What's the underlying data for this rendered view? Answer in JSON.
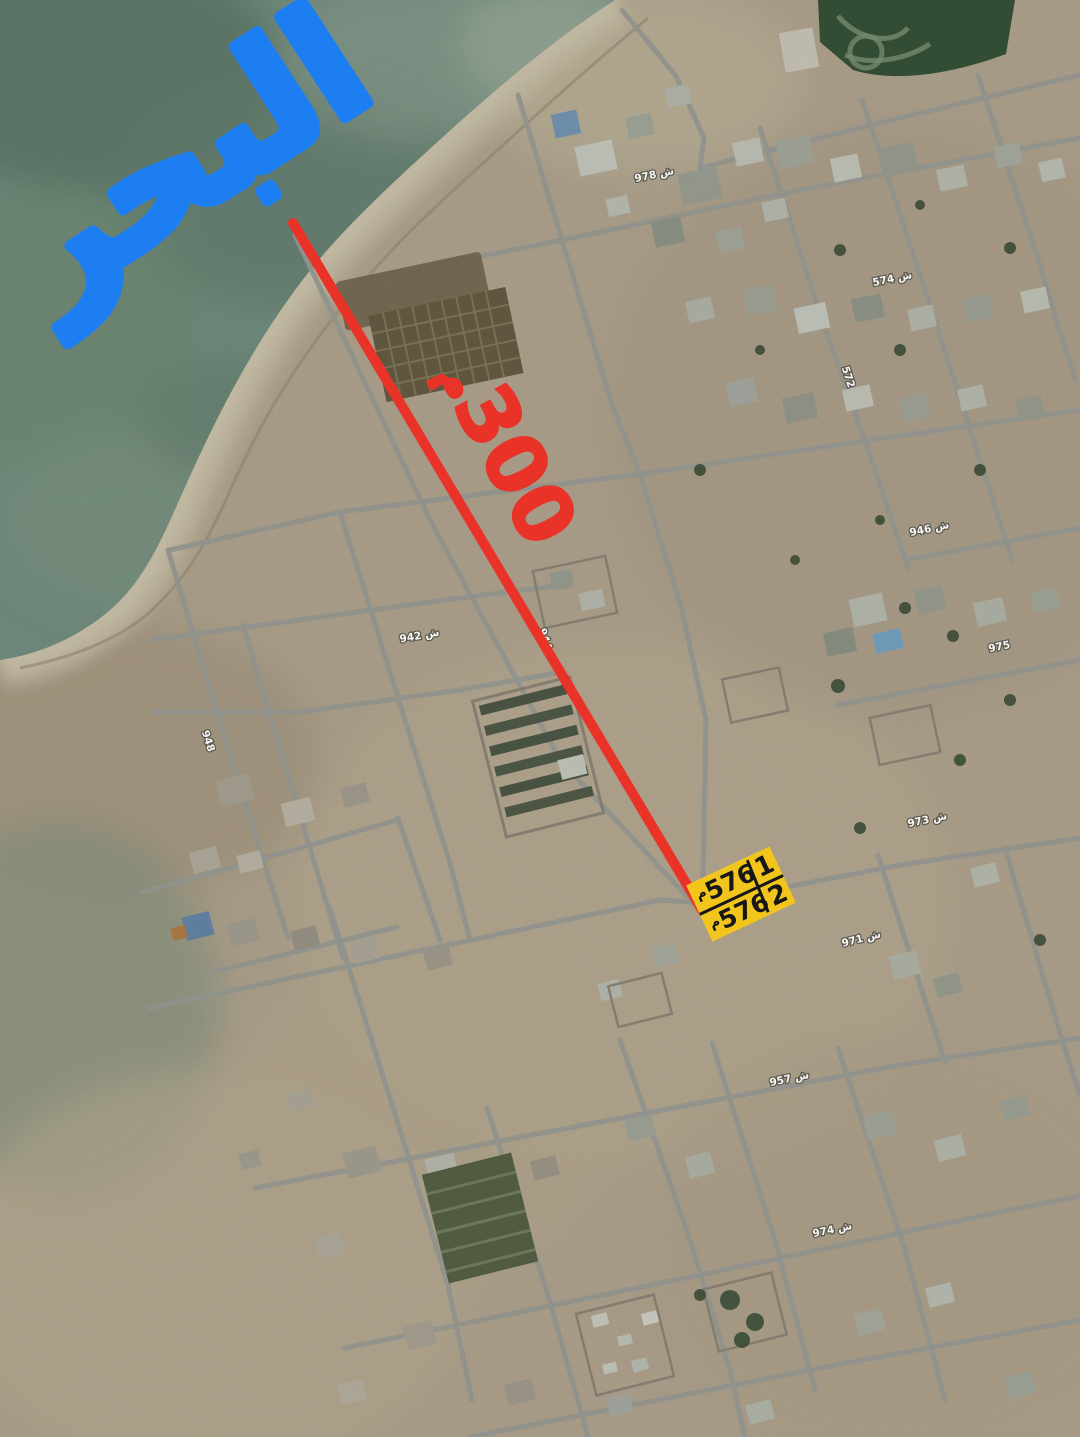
{
  "annotations": {
    "sea_label": {
      "text": "البحر",
      "color": "#1d7ef2"
    },
    "route_line": {
      "color": "#ea3328"
    },
    "distance_label": {
      "unit": "م",
      "value": "300",
      "color": "#ea3328"
    },
    "parcel_highlight": {
      "fill": "#f2c51d",
      "ink": "#171717",
      "rows": [
        {
          "unit": "م",
          "value": "576",
          "plot": "1"
        },
        {
          "unit": "م",
          "value": "576",
          "plot": "2"
        }
      ]
    }
  },
  "street_labels": [
    {
      "text": "978 ش",
      "x": 655,
      "y": 178,
      "rot": -12
    },
    {
      "text": "574 ش",
      "x": 893,
      "y": 282,
      "rot": -12
    },
    {
      "text": "572",
      "x": 845,
      "y": 378,
      "rot": 72
    },
    {
      "text": "946 ش",
      "x": 930,
      "y": 532,
      "rot": -12
    },
    {
      "text": "944",
      "x": 542,
      "y": 640,
      "rot": 72
    },
    {
      "text": "942 ش",
      "x": 420,
      "y": 639,
      "rot": -10
    },
    {
      "text": "975",
      "x": 1000,
      "y": 650,
      "rot": -12
    },
    {
      "text": "948",
      "x": 205,
      "y": 742,
      "rot": 72
    },
    {
      "text": "973 ش",
      "x": 928,
      "y": 823,
      "rot": -12
    },
    {
      "text": "971 ش",
      "x": 862,
      "y": 942,
      "rot": -14
    },
    {
      "text": "957 ش",
      "x": 790,
      "y": 1082,
      "rot": -12
    },
    {
      "text": "974 ش",
      "x": 833,
      "y": 1233,
      "rot": -12
    }
  ],
  "palette": {
    "sea": "#7e9c8d",
    "sand": "#c2b49c",
    "beach": "#d8cdb2",
    "road": "#a8aba3"
  }
}
